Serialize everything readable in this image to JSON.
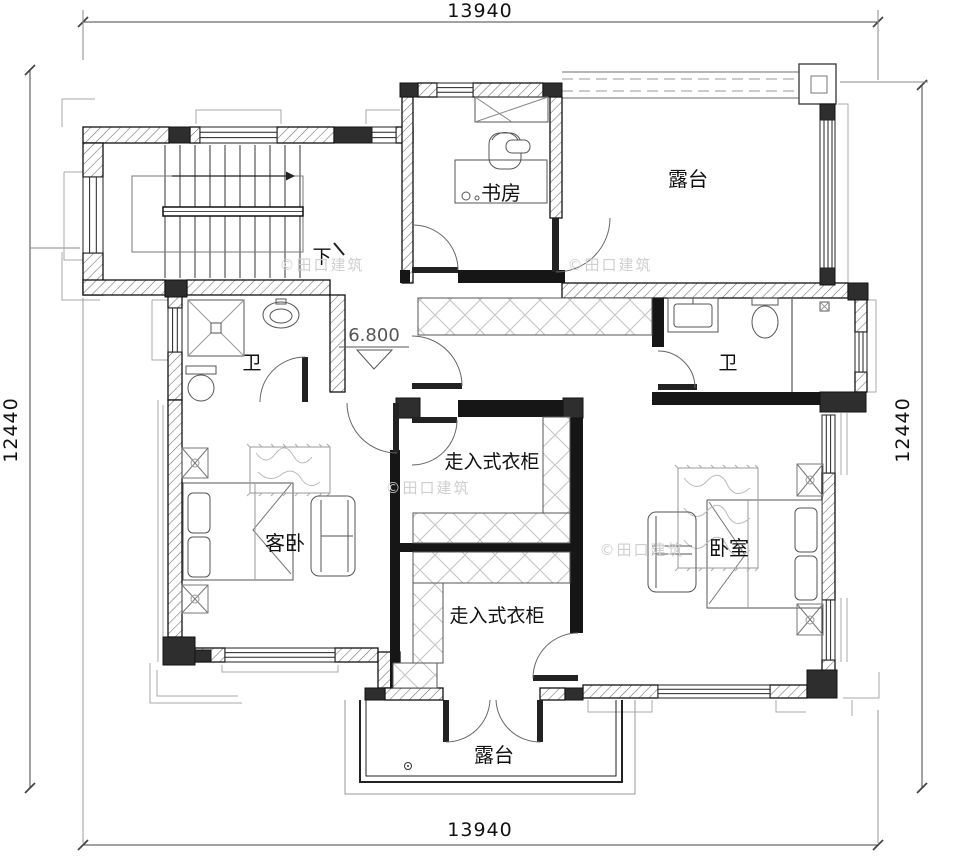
{
  "drawing": {
    "dims": {
      "top": "13940",
      "bottom": "13940",
      "left": "12440",
      "right": "12440"
    },
    "elevation": "6.800",
    "stair_down": "下",
    "watermark": "©田口建筑",
    "rooms": {
      "study": "书房",
      "terrace_top": "露台",
      "bath_left": "卫",
      "bath_right": "卫",
      "guest_bedroom": "客卧",
      "closet_upper": "走入式衣柜",
      "closet_lower": "走入式衣柜",
      "bedroom": "卧室",
      "terrace_bottom": "露台"
    }
  }
}
